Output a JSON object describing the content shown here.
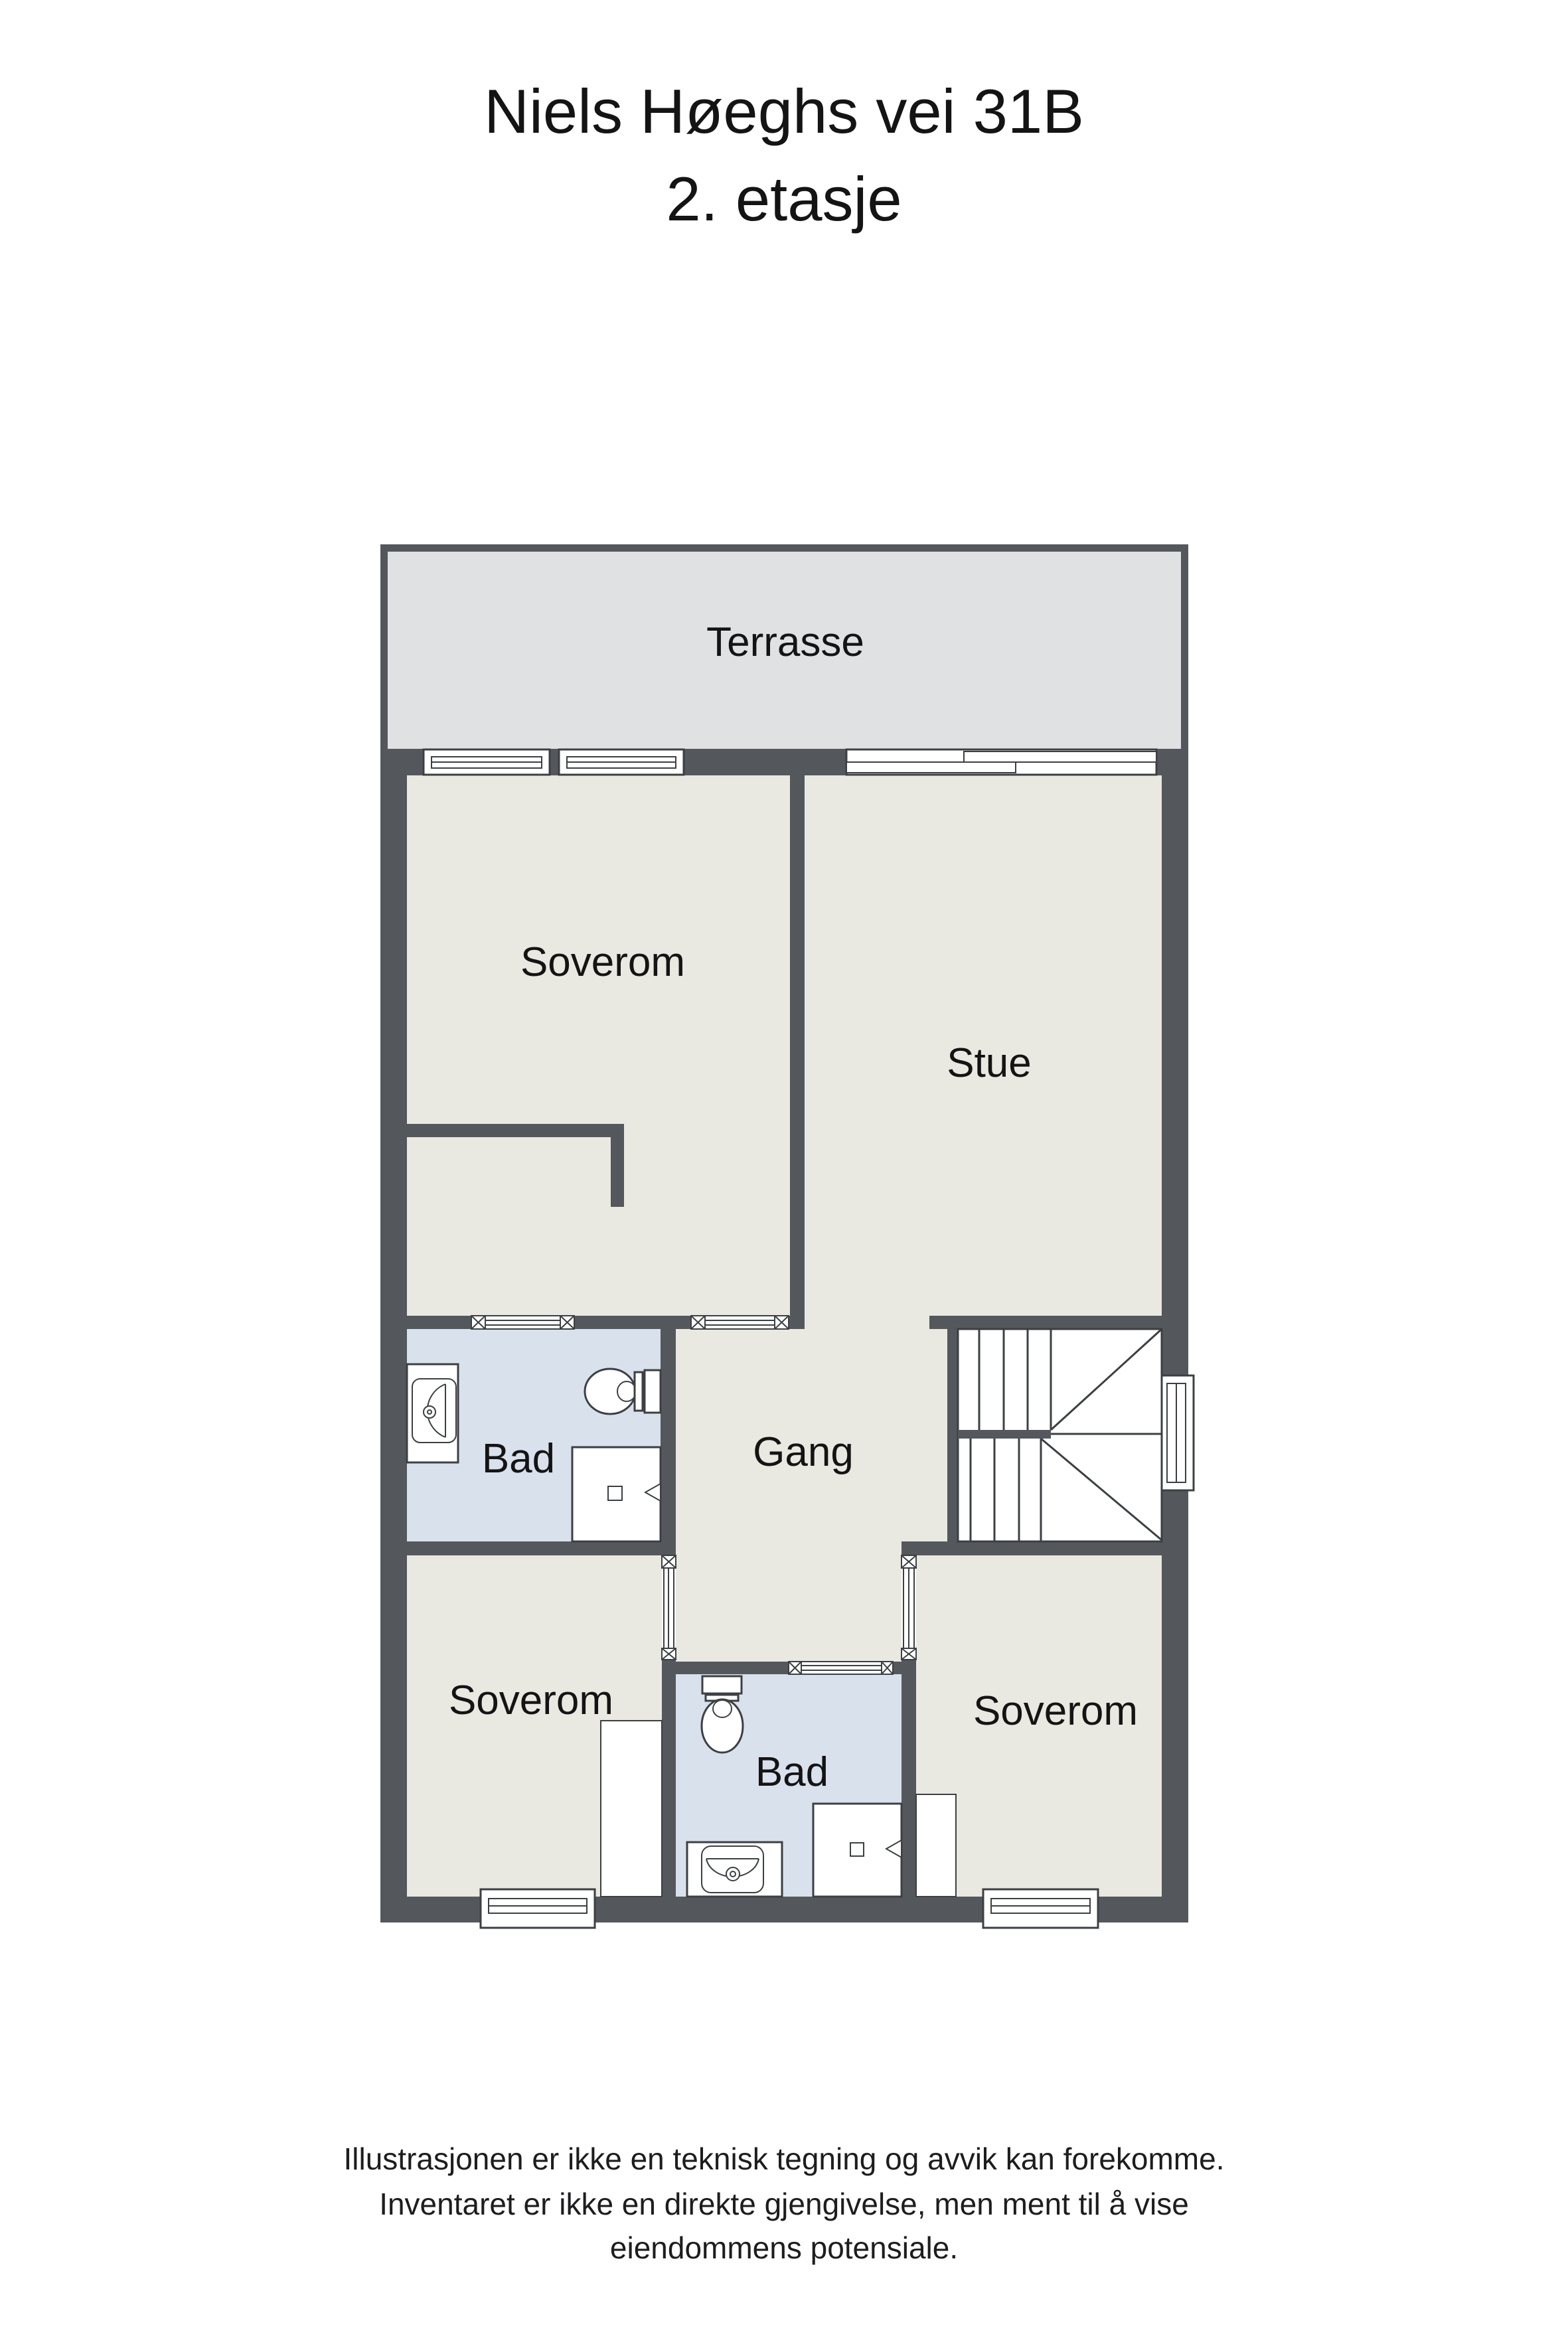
{
  "title": {
    "line1": "Niels Høeghs vei 31B",
    "line2": "2. etasje"
  },
  "rooms": {
    "terrasse": "Terrasse",
    "soverom_top": "Soverom",
    "stue": "Stue",
    "bad_top": "Bad",
    "gang": "Gang",
    "soverom_left": "Soverom",
    "bad_bottom": "Bad",
    "soverom_right": "Soverom"
  },
  "disclaimer": {
    "line1": "Illustrasjonen er ikke en teknisk tegning og avvik kan forekomme.",
    "line2": "Inventaret er ikke en direkte gjengivelse, men ment til å vise",
    "line3": "eiendommens potensiale."
  },
  "colors": {
    "wall": "#54585c",
    "floor": "#e9e9e1",
    "terrace": "#dfe1e3",
    "bathroom": "#d9e1ed",
    "fixture_outline": "#3c4043",
    "text": "#141414"
  }
}
